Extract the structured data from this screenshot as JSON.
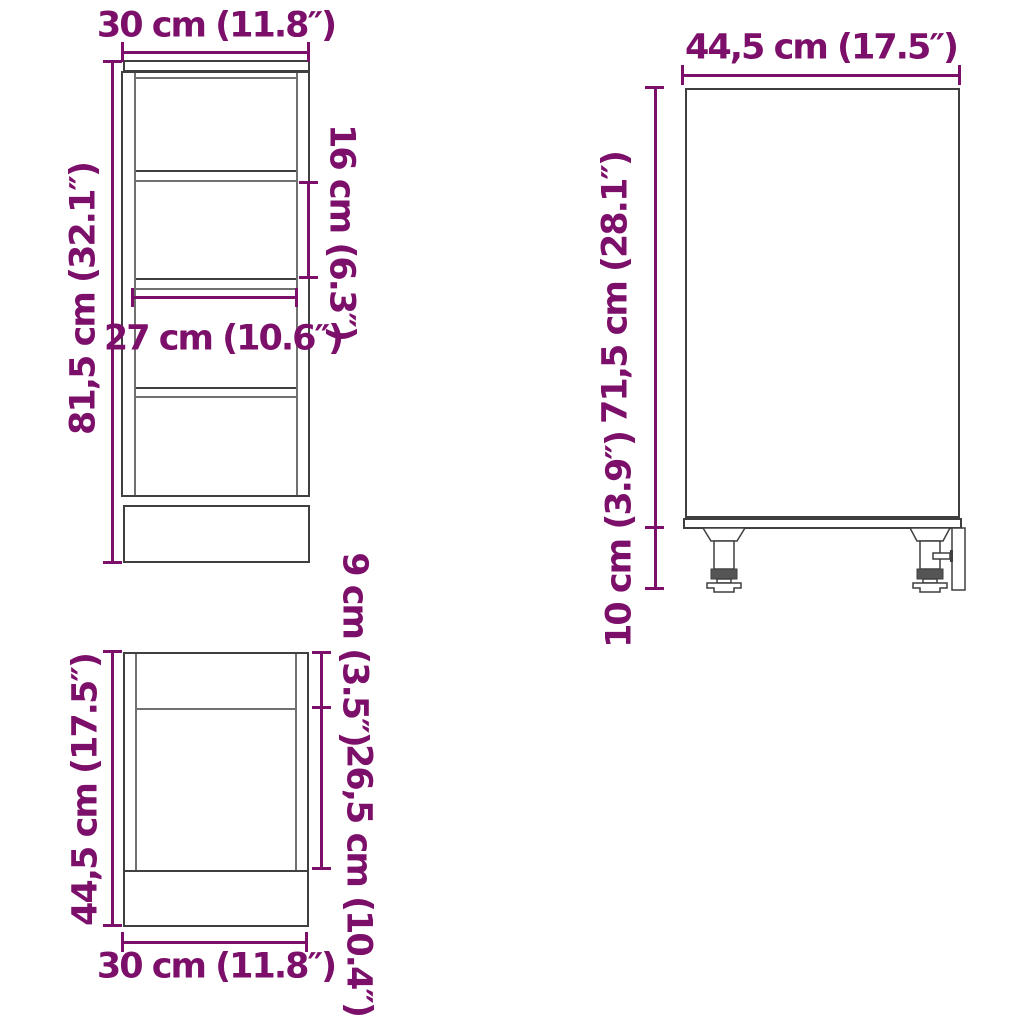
{
  "colors": {
    "dimension_text": "#7c0f6a",
    "outline": "#3f3f3f",
    "background": "#ffffff"
  },
  "views": {
    "front": {
      "width": "30 cm (11.8″)",
      "height": "81,5 cm (32.1″)",
      "shelf_spacing": "16 cm (6.3″)",
      "inner_width": "27 cm (10.6″)"
    },
    "top": {
      "depth": "44,5 cm (17.5″)",
      "width": "30 cm (11.8″)",
      "front_section": "9 cm (3.5″)",
      "middle_section": "26,5 cm (10.4″)"
    },
    "side": {
      "depth": "44,5 cm (17.5″)",
      "body_height": "71,5 cm (28.1″)",
      "leg_height": "10 cm (3.9″)"
    }
  }
}
